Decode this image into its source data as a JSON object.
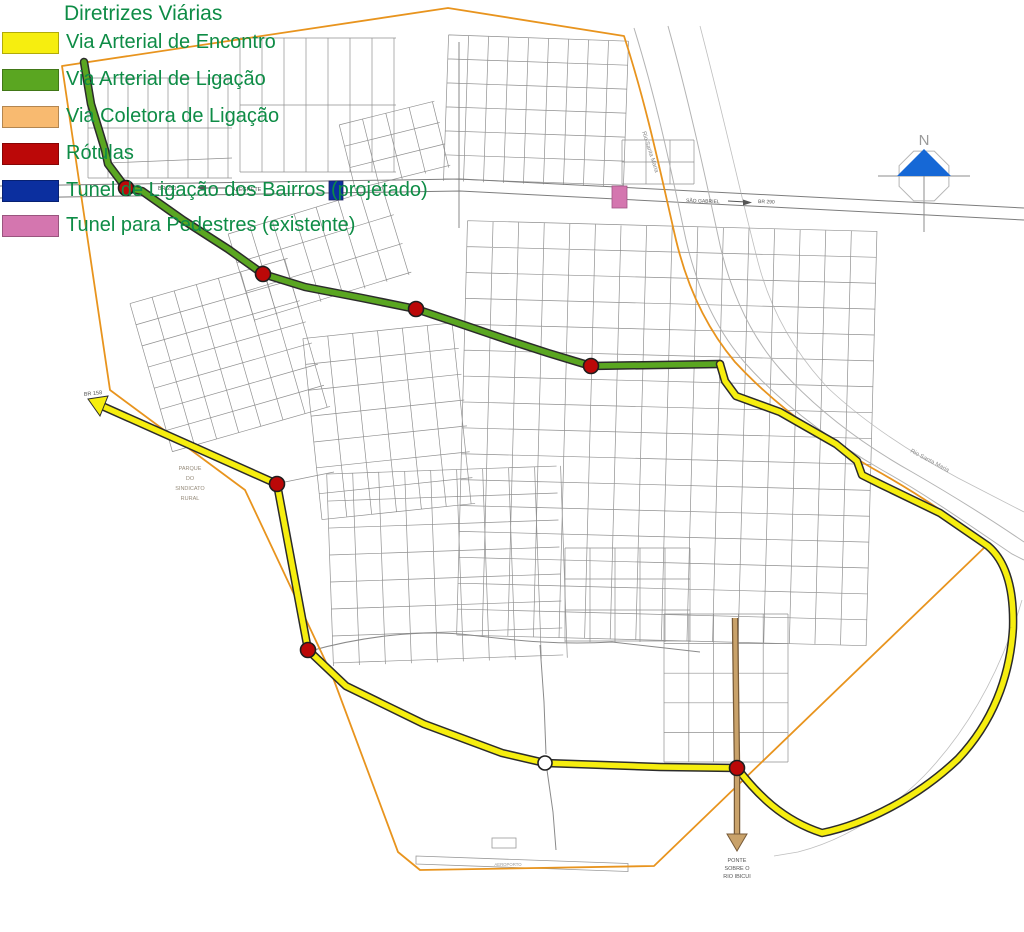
{
  "legend": {
    "title": "Diretrizes Viárias",
    "text_color": "#0e8c46",
    "items": [
      {
        "label": "Via Arterial de Encontro",
        "color": "#f6ee0f"
      },
      {
        "label": "Via Arterial de Ligação",
        "color": "#5aa621"
      },
      {
        "label": "Via Coletora de Ligação",
        "color": "#f8ba70"
      },
      {
        "label": "Rótulas",
        "color": "#bb0808"
      },
      {
        "label": "Tunel de Ligação dos Bairros (projetado)",
        "color": "#0b2f9f"
      },
      {
        "label": "Tunel para Pedestres (existente)",
        "color": "#d476af"
      }
    ]
  },
  "map_labels": {
    "north": "N",
    "br290_left": "BR 290",
    "alegrete": "ALEGRETE",
    "sao_gabriel": "SÃO GABRIEL",
    "br290_right": "BR 290",
    "br158": "BR 158",
    "rio_santa_maria_top": "Rio Santa Maria",
    "rio_santa_maria_east": "Rio Santa Maria",
    "parque": {
      "l1": "PARQUE",
      "l2": "DO",
      "l3": "SINDICATO",
      "l4": "RURAL"
    },
    "ponte": {
      "l1": "PONTE",
      "l2": "SOBRE O",
      "l3": "RIO IBICUI"
    },
    "aeroporto": "AEROPORTO"
  },
  "map_colors": {
    "boundary_orange": "#e8941e",
    "street_gray": "#909090",
    "river_gray": "#b3b3b3",
    "road_tan": "#c9a26a",
    "road_tan_dark": "#775a38",
    "north_arrow_blue": "#1668d6",
    "label_gray": "#555555"
  }
}
